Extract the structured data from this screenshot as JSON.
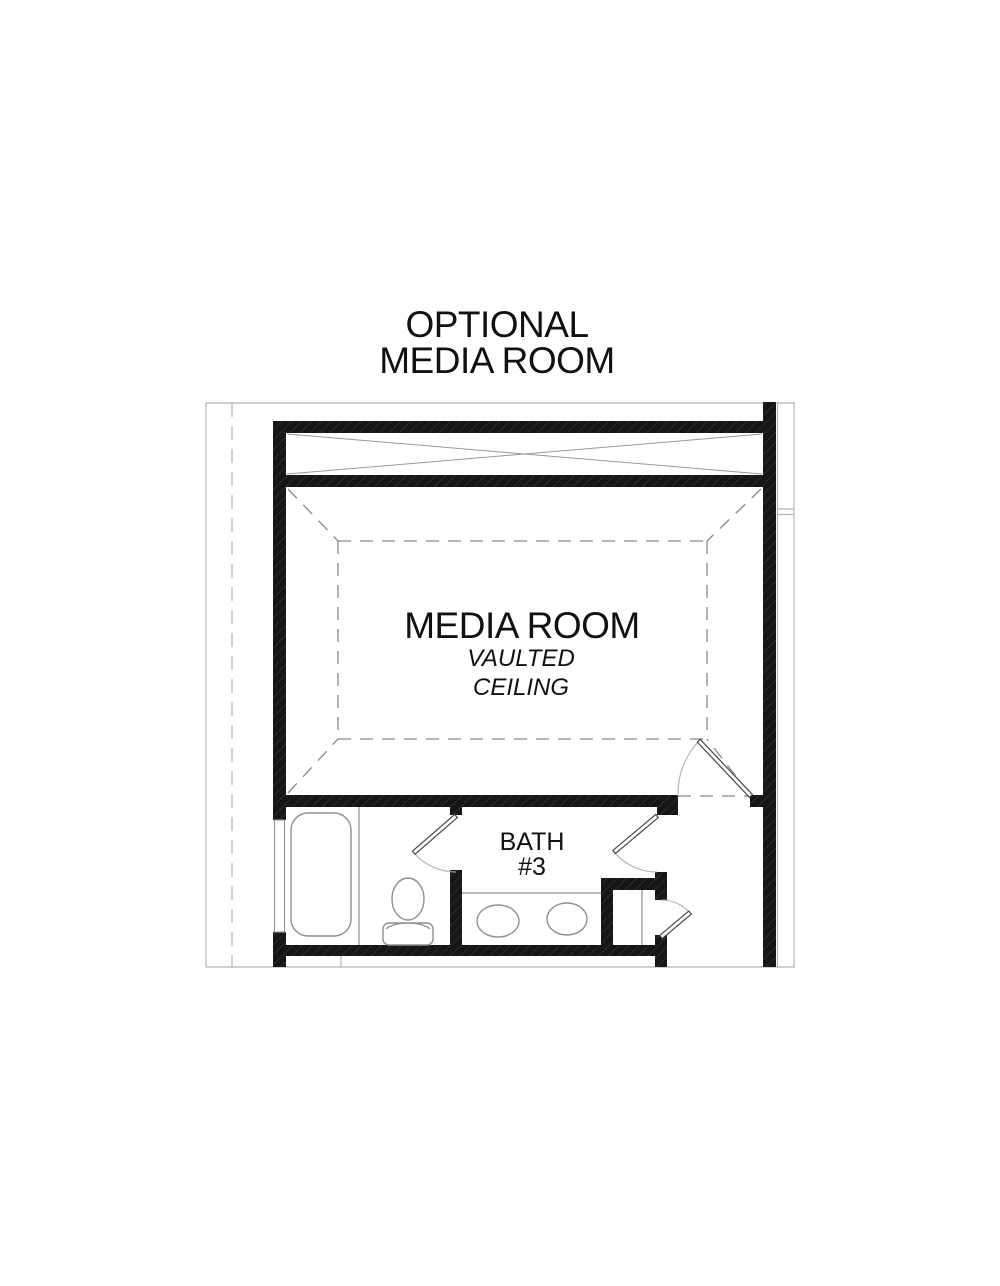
{
  "title": {
    "line1": "OPTIONAL",
    "line2": "MEDIA ROOM"
  },
  "media_room": {
    "label": "MEDIA ROOM",
    "ceiling_note_line1": "VAULTED",
    "ceiling_note_line2": "CEILING"
  },
  "bath": {
    "label": "BATH",
    "number": "#3"
  },
  "fixtures": {
    "bathtub": "bathtub",
    "toilet": "toilet",
    "vanity_sink_left": "sink",
    "vanity_sink_right": "sink",
    "linen_closet_shelf": "shelf",
    "window": "window"
  },
  "colors": {
    "background": "#ffffff",
    "wall": "#161616",
    "line_light": "#b5b5b5",
    "line_medium": "#8a8a8a",
    "text": "#111111"
  }
}
